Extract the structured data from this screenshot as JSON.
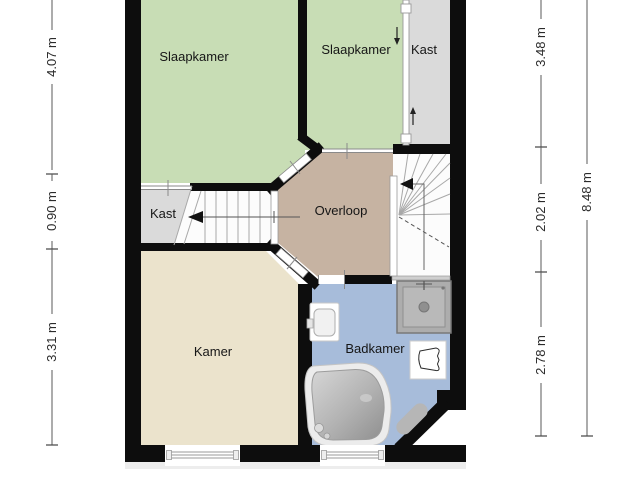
{
  "plan": {
    "type": "floor-plan",
    "rooms": {
      "slaapkamer_1": {
        "label": "Slaapkamer"
      },
      "slaapkamer_2": {
        "label": "Slaapkamer"
      },
      "kast_1": {
        "label": "Kast"
      },
      "kast_2": {
        "label": "Kast"
      },
      "overloop": {
        "label": "Overloop"
      },
      "kamer": {
        "label": "Kamer"
      },
      "badkamer": {
        "label": "Badkamer"
      }
    },
    "dimensions": {
      "left": {
        "top": "4.07 m",
        "middle": "0.90 m",
        "bottom": "3.31 m"
      },
      "right": {
        "top": "3.48 m",
        "middle": "2.02 m",
        "bottom": "2.78 m",
        "total": "8.48 m"
      }
    },
    "colors": {
      "bedroom_green": "#c8ddb5",
      "closet_gray": "#dadada",
      "landing_tan": "#c6b3a2",
      "room_beige": "#ebe3cc",
      "bathroom_blue": "#a7bcda",
      "wall_black": "#0d0d0d",
      "stairs_white": "#fcfcfc",
      "shadow_gray": "#ededed"
    },
    "fixtures": {
      "bathtub": "bathtub-icon",
      "shower": "shower-icon",
      "toilet": "toilet-icon",
      "washbasin": "washbasin-icon",
      "bath_mat": "bath-mat-icon",
      "stairs_left": "staircase-icon",
      "stairs_right": "staircase-icon",
      "sliding_door": "sliding-door-icon",
      "windows": "window-icon"
    }
  }
}
